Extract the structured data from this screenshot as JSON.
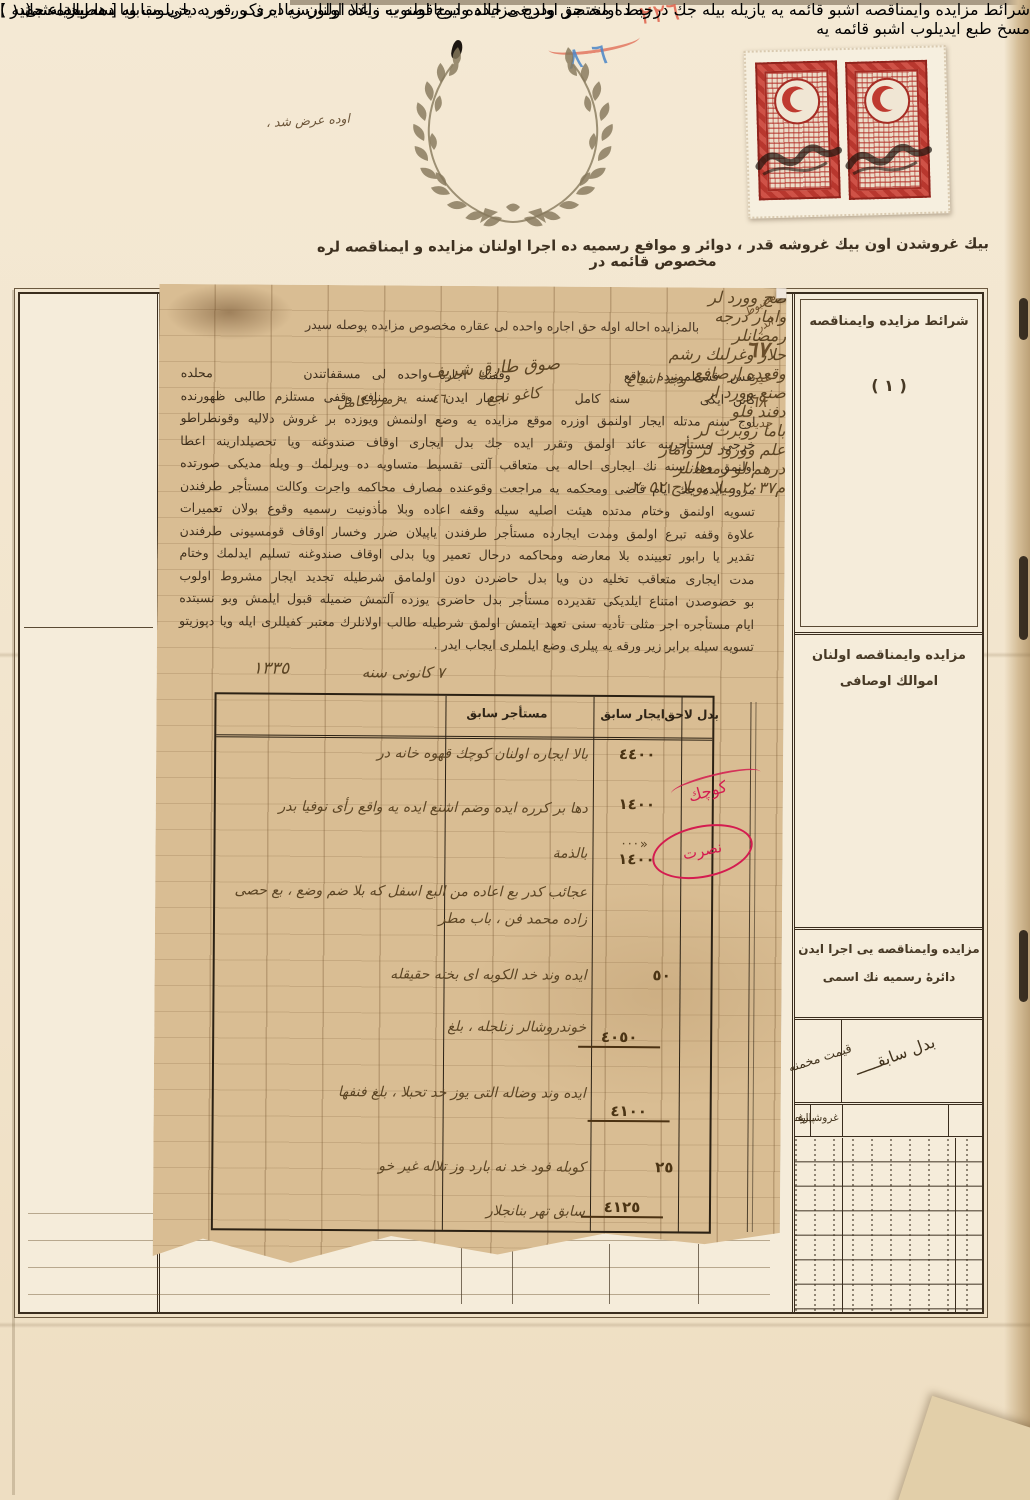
{
  "colors": {
    "paper": "#f2e4cc",
    "glued_paper": "#d9bd93",
    "red_stamp": "#c14238",
    "lilac_stamp": "#b286c0",
    "cancel_violet": "#42268e",
    "red_ink": "#d41c50",
    "blue_crayon": "#4a86c8",
    "red_crayon": "#e0604a",
    "printed_ink": "#3f2f1c"
  },
  "page_top": {
    "red_crayon_number": "٢٢٦",
    "blue_crayon_number": "٦ ٨",
    "handwritten_note": "اوده عرض شد ،"
  },
  "header_line": "بيك غروشدن اون بيك غروشه قدر ، دوائر و موافع رسميه ده اجرا اولنان مزايده و ايمناقصه لره مخصوص قائمه در",
  "base_form": {
    "right_column": {
      "cell1_title": "شرائط مزايده وايمناقصه",
      "cell1_number": "( ١ )",
      "cell2_line1": "مزايده وايمناقصه اولنان",
      "cell2_line2": "اموالك اوصافی",
      "cell3_line1": "مزايده وايمناقصه يی اجرا ايدن",
      "cell3_line2": "دائرهٔ رسميه نك اسمی",
      "diag_right": "بدل سابقـــــ",
      "diag_left": "قيمت مخمنه",
      "units": [
        "پاره",
        "غروشــــــ",
        "پاره",
        "غـ"
      ]
    }
  },
  "glued_sheet": {
    "header": "بالمزايده احاله اوله حق اجاره واحده لی عقاره مخصوص مزايده پوصله سيدر",
    "margin_notes": [
      "مضبوط",
      "اندر",
      "٦٧",
      "غير",
      "٦٨",
      "جديد"
    ],
    "inline_handwriting": [
      "صوق طارق شريف",
      "وجد اشياع",
      "زمره كامل",
      "٤٦",
      "كاغو نجع"
    ],
    "body_lines": [
      "نفس قسطمونيده واقع          وقفنك اجارهٔ واحده لی مسقفاتندن        محلده",
      "كائن ايكی        سنه كامل        اعتبار ايدن سنه يه منافع وقفی مستلزم طالبی ظهورنده",
      "اوج سنه مدتله ايجار اولنمق اوزره موقع مزايده يه وضع اولنمش ويوزده بر غروش دلاليه وقونطراطو",
      "خرجی مستأجرينه عائد اولمق وتقرر ايده جك بدل ايجاری اوقاف صندوغنه ويا تحصيلدارينه اعطا",
      "اولنمق وهر سنه نك ايجاری احاله یی متعاقب آلتی تقسيط متساويه ده ويرلمك و ويله مديكی صورتده",
      "مرور ايده جك ايام قاضی ومحكمه يه مراجعت وقوعنده مصارف محاكمه واجرت وكالت مستأجر طرفندن",
      "تسويه اولنمق وختام مدتده هيئت اصليه سيله وقفه اعاده وبلا مأذونيت رسميه وقوع بولان تعميرات",
      "علاوة وقفه تبرع اولمق ومدت ايجارده مستأجر طرفندن ياپيلان ضرر وخسار اوقاف قومسيونی طرفندن",
      "تقدير يا رابور تعيينده بلا معارضه ومحاكمه درحال تعمير ويا بدلی اوقاف صندوغنه تسليم ايدلمك وختام",
      "مدت ايجاری متعاقب تخليه دن ويا بدل حاضردن دون اولمامق شرطيله تجديد ايجار مشروط اولوب",
      "بو خصوصدن امتناع ايلديكی تقديرده مستأجر بدل حاضری يوزده آلتمش ضميله قبول ايلمش وبو نسبتده",
      "ايام مستأجره اجر مثلی تأديه سنی تعهد ايتمش اولمق شرطيله طالب اولانلرك معتبر كفيللری ايله ويا دپوزيتو",
      "تسويه سيله برابر زير ورقه يه پيلری وضع ايلملری ايجاب ايدر ."
    ],
    "date_day": "٧ كانونی سنه",
    "date_year": "١٣٣٥",
    "table": {
      "header_bedel": "بدل لاحق",
      "header_icar": "ايجار سابق",
      "header_mustecir": "مستأجر سابق",
      "rows": [
        {
          "desc": "بالا ايجاره اولنان كوچك قهوه خانه در",
          "value": "٤٤٠٠"
        },
        {
          "desc": "دها بر كرره ايده وضم اشنع ايده يه واقع رأی نوفيا بدر",
          "value": "١٤٠٠"
        },
        {
          "desc": "بالذمة",
          "value": "١٤٠٠"
        },
        {
          "desc": "عجائب كدر بع اعاده من البع اسفل كه بلا ضم وضع ، بع حصی زاده محمد فن ، باب مطر",
          "value": ""
        },
        {
          "desc": "ايده وند خد الكوبه ای بخته حقيقله",
          "value": "٥٠"
        },
        {
          "desc": "خوندروشالر زنلجله ، بلغ",
          "value": "٤٠٥٠"
        },
        {
          "desc": "ايده وند وضاله التی يوز خد تحبلا ، بلغ فنفها",
          "value": "٤١٠٠"
        },
        {
          "desc": "كوبله فود خد نه بارد وز تلاله غير خو",
          "value": "٢٥"
        },
        {
          "desc": "سابق تهر بنانجلار",
          "value": "٤١٢٥"
        }
      ]
    },
    "left_margin_handwriting": [
      "باما روبرت لر",
      "علم وورود لر وامار",
      "درهم لو رمضانلر"
    ],
    "stamp1_scrawl": [
      "صح وورد لر",
      "وامار درجه",
      "رمضانلر"
    ],
    "stamp2_scrawl": [
      "حلار وغرلٮك رشم",
      "وقعده ارصافع"
    ],
    "stamp3_scrawl": [
      "صنع وورد ار",
      "دفند فلو"
    ],
    "red_ink": {
      "word": "كوچك",
      "circled": "نصرت",
      "arrow": "«···"
    },
    "signature": "م٢٠٣٧ ميلا يويلاج ٢٠٥٢"
  },
  "footnote": {
    "marker": "( ١ )",
    "line1": "شرائط مزايده وايمناقصه اشبو قائمه يه يازيله بيله جك درجه ده مختصر اولديغی حالده درج اولنوب زياده اولورسه ايری ورقه يه يازيلوب ويا دها زياده سی مسخ طبع ايديلوب اشبو قائمه يه",
    "line2": "ربط اولنه جق ودرج مزايده وايمناقصه يه واغلا اولنان زياده ذكر ، ورد دخی مقابله سنه يازيله جقدر .",
    "imprint": "[ مطبعة عثمانيه ]"
  }
}
